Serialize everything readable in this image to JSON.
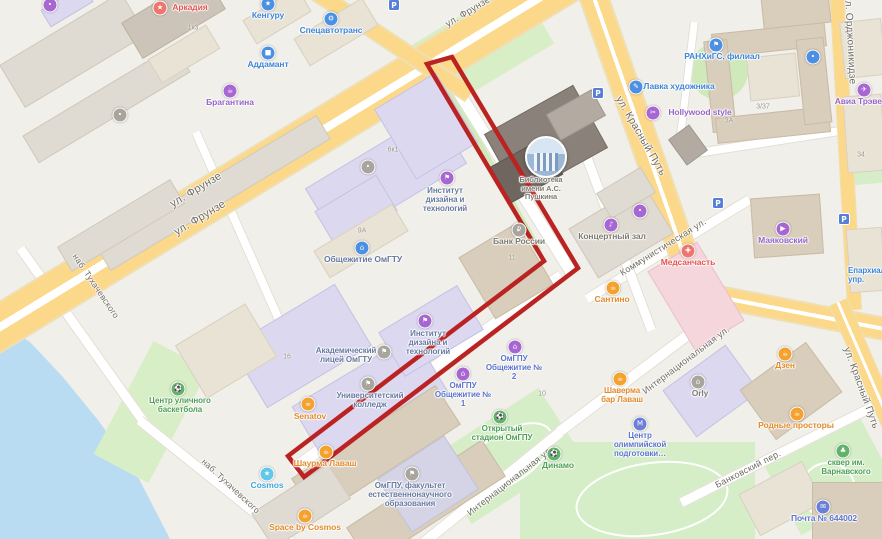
{
  "streets": {
    "frunze": "ул. Фрунзе",
    "krasny_put": "ул. Красный Путь",
    "ordzhonikidze": "ул. Орджоникидзе",
    "kommunisticheskaya": "Коммунистическая ул.",
    "internatsionalnaya": "Интернациональная ул.",
    "tukhachevskogo": "наб. Тухачевского",
    "bankovsky": "Банковский пер."
  },
  "poi": {
    "arkadia": "Аркадия",
    "kenguru": "Кенгуру",
    "spetsavtotrans": "Спецавтотранс",
    "addamant": "Аддамант",
    "bragantina": "Брагантина",
    "lavka_khudozhnika": "Лавка художника",
    "hollywood_style": "Hollywood style",
    "ranhigs": "РАНХиГС, филиал",
    "avia_travel": "Авиа Трэвел",
    "mayakovsky": "Маяковский",
    "library": "Библиотека имени А.С. Пушкина",
    "design_institute": "Институт дизайна и технологий",
    "dorm_omgtu": "Общежитие ОмГТУ",
    "bank_rossii": "Банк России",
    "concert_hall": "Концертный зал",
    "medsanchast": "Медсанчасть",
    "santino": "Сантино",
    "akadem_lyceum": "Академический лицей ОмГТУ",
    "univer_college": "Университетский колледж",
    "omgpu_dorm1": "ОмГПУ Общежитие № 1",
    "omgpu_dorm2": "ОмГПУ Общежитие № 2",
    "omgpu_stadium": "Открытый стадион ОмГПУ",
    "omgpu_faculty": "ОмГПУ, факультет естественнонаучного образования",
    "basketball_center": "Центр уличного баскетбола",
    "senatov": "Senatov",
    "shaurma_lavash": "Шаурма Лаваш",
    "cosmos": "Cosmos",
    "space_by_cosmos": "Space by Cosmos",
    "dinamo": "Динамо",
    "shaverma_bar": "Шаверма бар Лаваш",
    "olympic_center": "Центр олимпийской подготовки…",
    "orly": "Orly",
    "dzen": "Дзен",
    "rodnye_prostory": "Родные просторы",
    "skver_varnavskogo": "сквер им. Варнавского",
    "pochta": "Почта № 644002",
    "eparkhia": "Епархиальное упр."
  },
  "numbers": {
    "n1": "1к3",
    "n2": "6к1",
    "n3": "9А",
    "n4": "11",
    "n5": "16",
    "n6": "10",
    "n7": "3/37",
    "n8": "3А",
    "n9": "34"
  },
  "glyphs": {
    "star": "★",
    "gear": "⚙",
    "block": "■",
    "coffee": "☕",
    "pencil": "✎",
    "scissors": "✂",
    "flag": "⚑",
    "plane": "✈",
    "play": "▶",
    "home": "⌂",
    "ruble": "₽",
    "music": "♪",
    "cross": "✚",
    "ball": "⚽",
    "m": "М",
    "club": "♣",
    "envelope": "✉",
    "dot": "•",
    "p": "P"
  },
  "route": {
    "color": "#bb2323",
    "points": [
      [
        427,
        64
      ],
      [
        452,
        57
      ],
      [
        578,
        268
      ],
      [
        304,
        477
      ],
      [
        288,
        456
      ],
      [
        544,
        261
      ]
    ]
  },
  "colors": {
    "road_major": "#fcd88b",
    "water": "#b9dcf2",
    "green": "#d6eec8",
    "route": "#bb2323"
  }
}
